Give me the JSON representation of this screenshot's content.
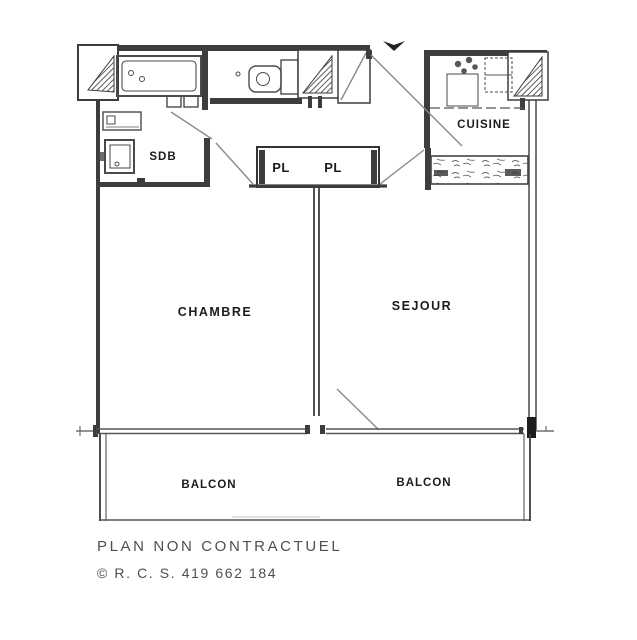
{
  "plan": {
    "labels": {
      "sdb": "SDB",
      "cuisine": "CUISINE",
      "pl_left": "PL",
      "pl_right": "PL",
      "chambre": "CHAMBRE",
      "sejour": "SEJOUR",
      "balcon_left": "BALCON",
      "balcon_right": "BALCON"
    },
    "footer": {
      "disclaimer": "PLAN NON CONTRACTUEL",
      "rcs": "© R. C. S. 419 662 184"
    },
    "colors": {
      "background": "#ffffff",
      "wall": "#3d3d3d",
      "thin_line": "#555555",
      "door_swing": "#8a8a8a",
      "label_text": "#1c1c1c",
      "footer_text": "#4f4f4f"
    }
  }
}
